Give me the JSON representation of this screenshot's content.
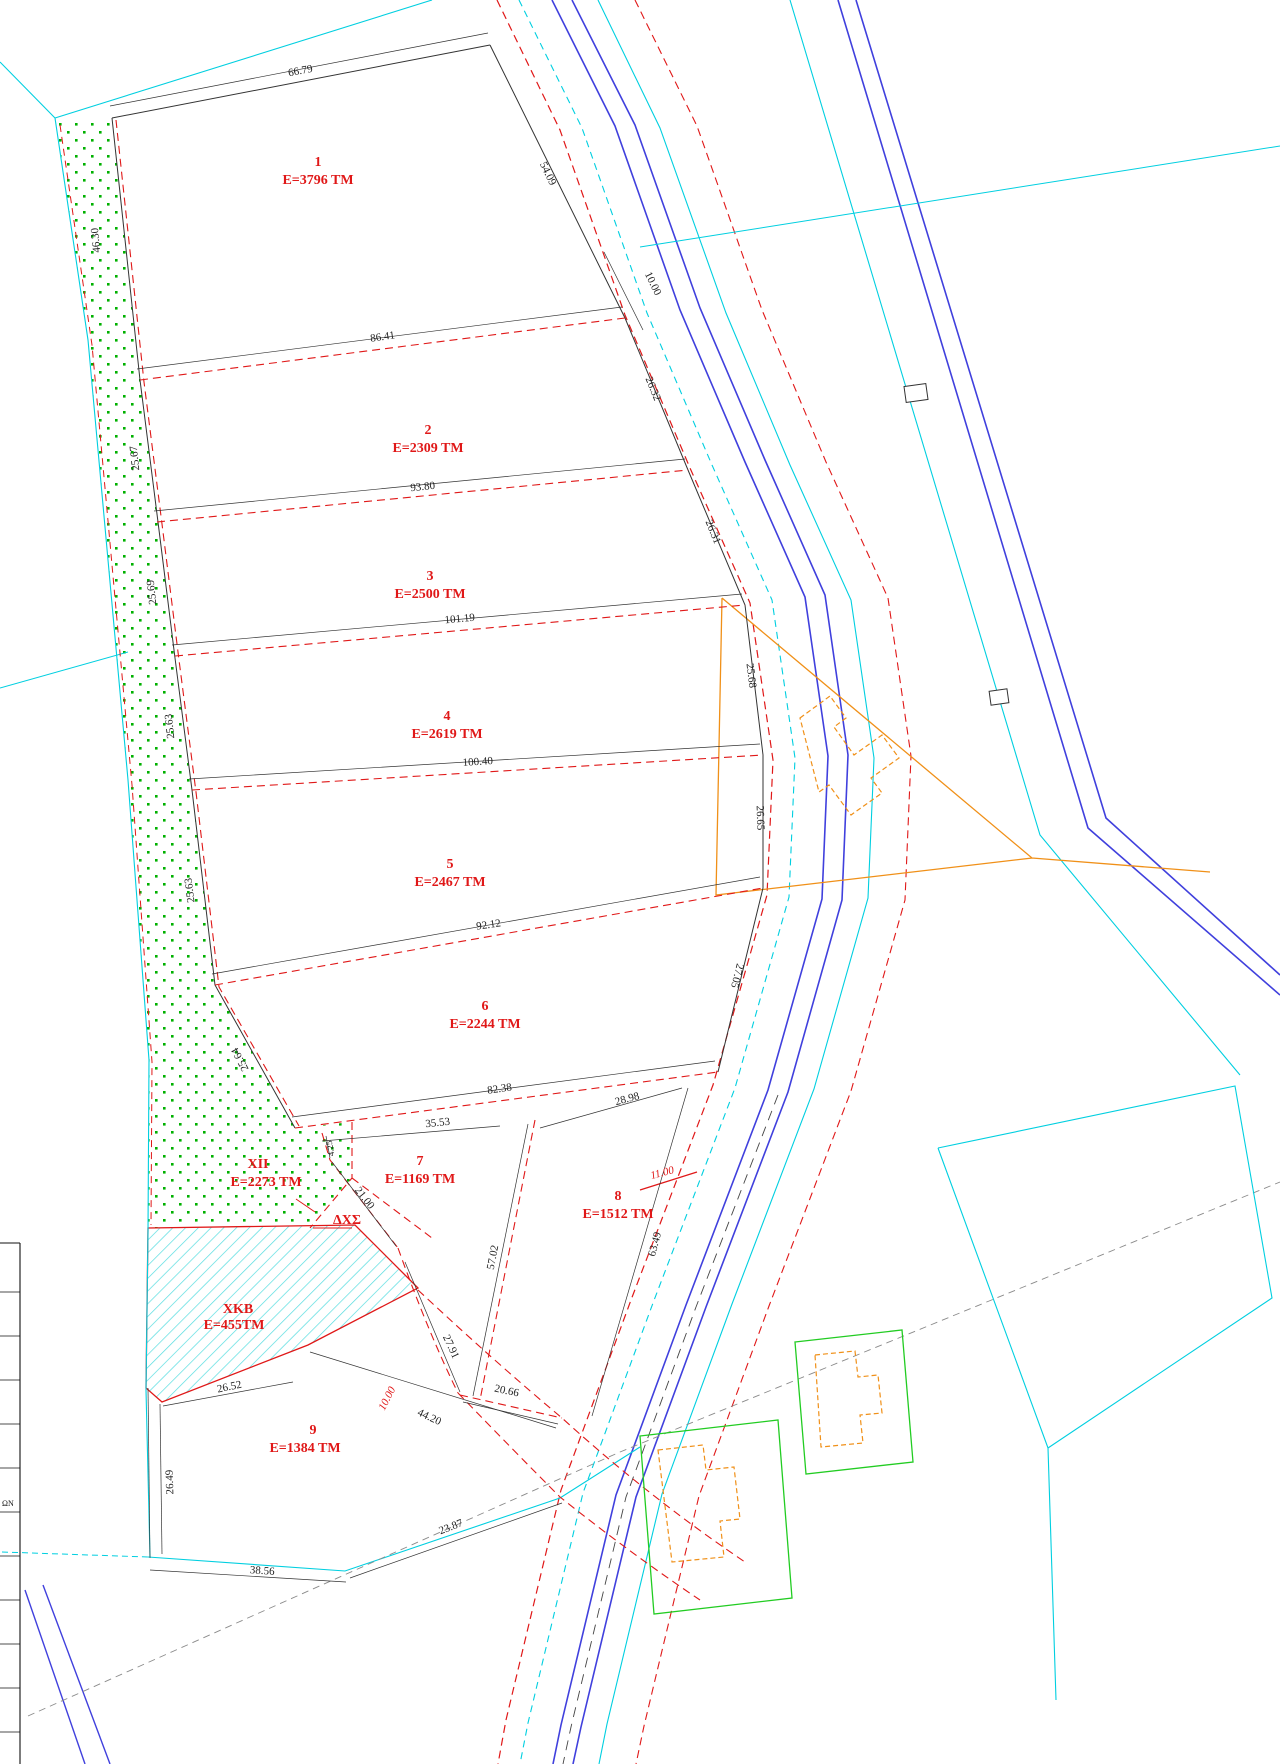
{
  "drawing": {
    "parcels": [
      {
        "num": "1",
        "area": "E=3796 TM"
      },
      {
        "num": "2",
        "area": "E=2309 TM"
      },
      {
        "num": "3",
        "area": "E=2500 TM"
      },
      {
        "num": "4",
        "area": "E=2619 TM"
      },
      {
        "num": "5",
        "area": "E=2467 TM"
      },
      {
        "num": "6",
        "area": "E=2244 TM"
      },
      {
        "num": "7",
        "area": "E=1169 TM"
      },
      {
        "num": "8",
        "area": "E=1512 TM"
      },
      {
        "num": "9",
        "area": "E=1384 TM"
      }
    ],
    "zones": [
      {
        "num": "ΧΙΙ",
        "area": "E=2273 TM"
      },
      {
        "num": "ΧΚΒ",
        "area": "E=455TM"
      },
      {
        "num": "ΔΧΣ",
        "area": ""
      }
    ],
    "dims": {
      "p1_top": "66.79",
      "p1_left": "46.30",
      "p1_right": "54.09",
      "road_offset_top": "10.00",
      "p2_top": "86.41",
      "p2_left": "25.67",
      "p2_right": "26.32",
      "p3_top": "93.80",
      "p3_left": "25.69",
      "p3_right": "26.31",
      "p4_top": "101.19",
      "p4_left": "25.63",
      "p4_right": "25.68",
      "p5_top": "100.40",
      "p5_left": "25.63",
      "p5_right": "26.65",
      "p6_top": "92.12",
      "p6_left": "25.64",
      "p6_right": "27.05",
      "p6_bottom": "82.38",
      "p7_top": "35.53",
      "p7_left_short": "4.25",
      "p7_left": "21.00",
      "p7_right": "57.02",
      "p7_curve": "27.91",
      "p8_top": "28.98",
      "p8_road_width": "11.00",
      "p8_right": "63.49",
      "p8_bottom": "20.66",
      "p9_top": "26.52",
      "p9_left": "26.49",
      "p9_bottom": "38.56",
      "p9_bottom_right": "23.87",
      "p9_diagonal": "44.20",
      "p9_road_width": "10.00"
    },
    "corner_text": "ΩΝ",
    "colors": {
      "boundary_red": "#e01818",
      "line_black": "#333333",
      "road_blue": "#4040dd",
      "cyan": "#00cfe0",
      "orange": "#f09018",
      "green_dots": "#00b000",
      "green_outline": "#22cc22",
      "hatch_cyan": "#55dde0"
    }
  }
}
